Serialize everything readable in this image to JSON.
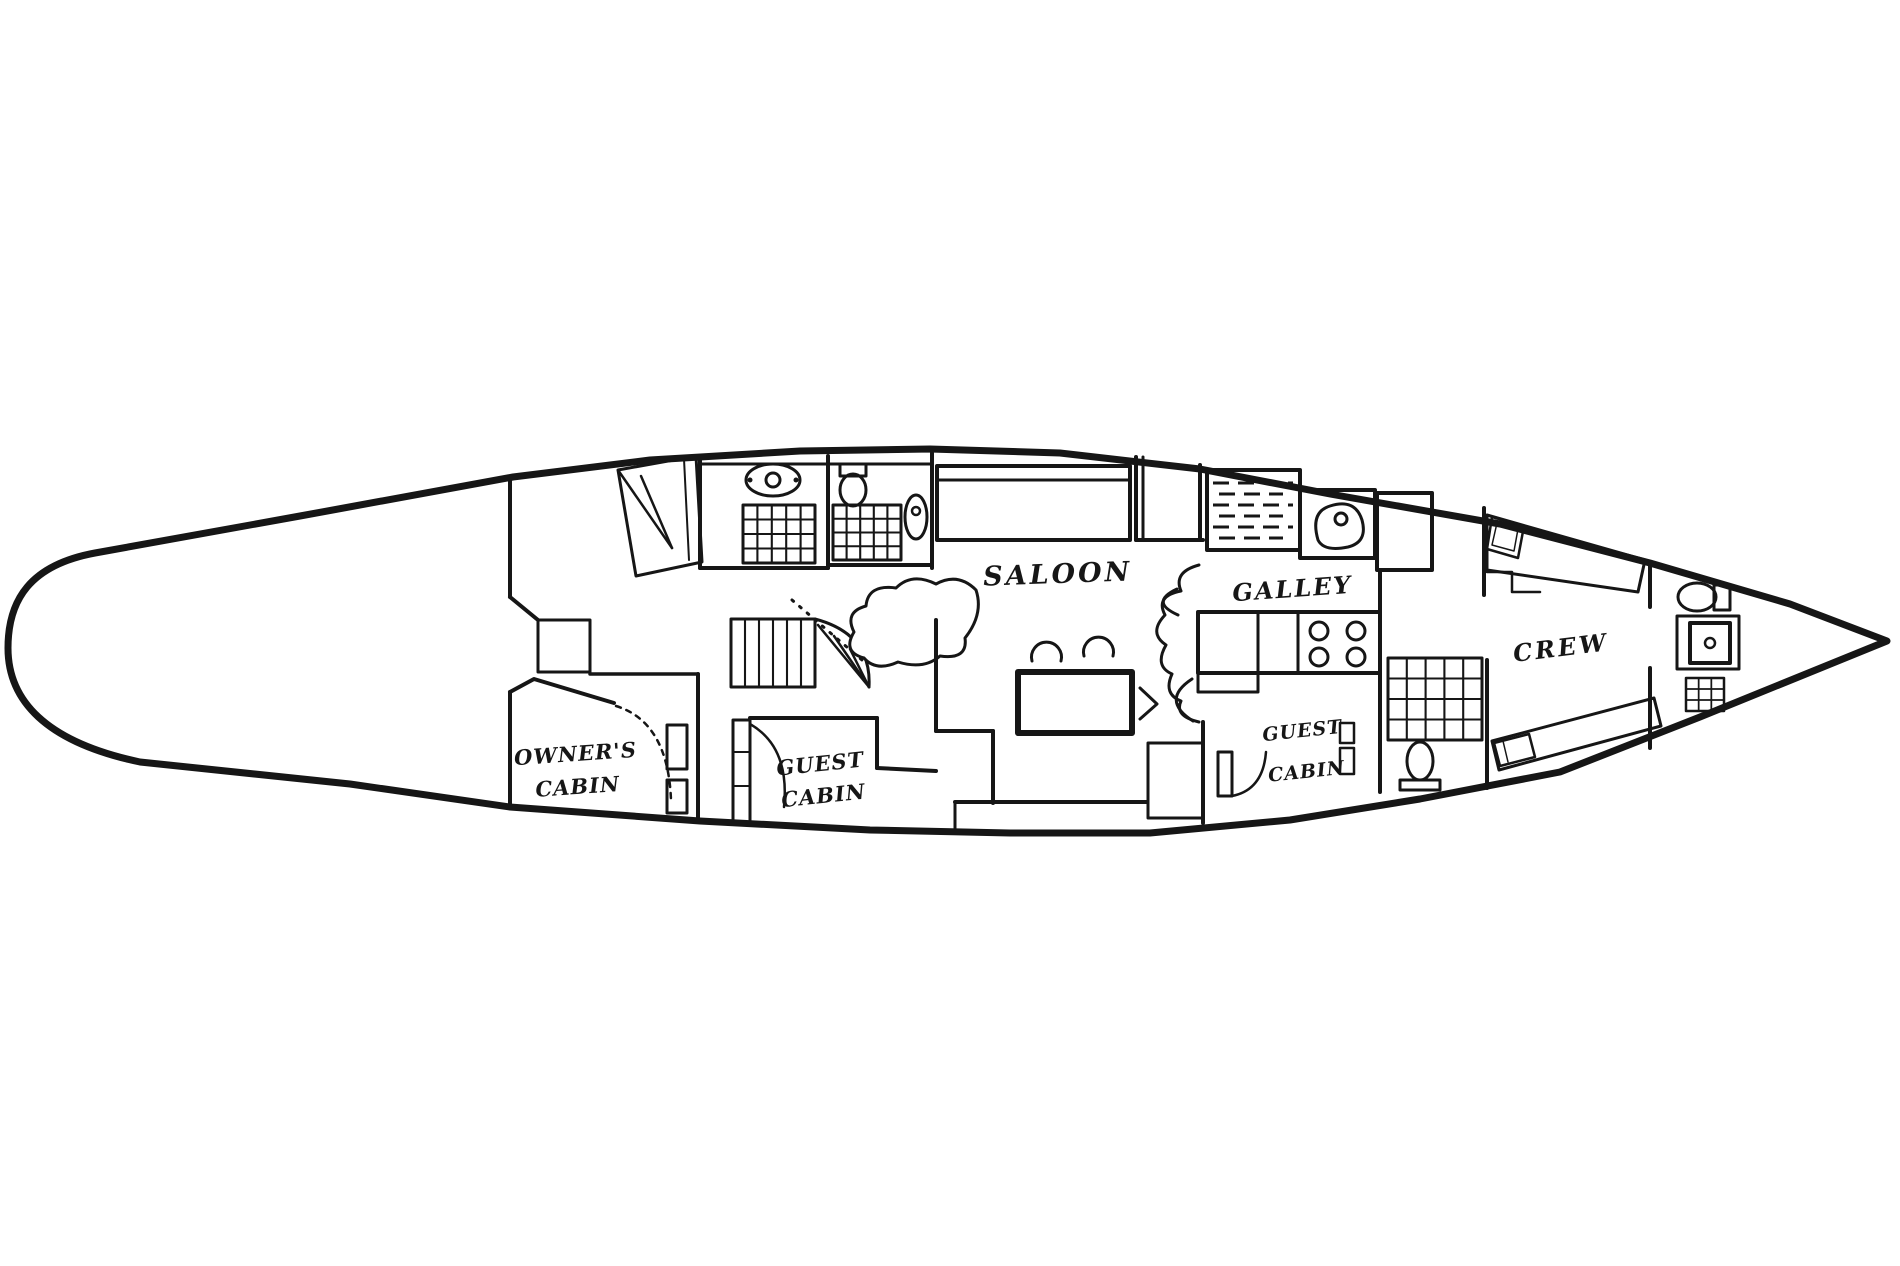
{
  "page": {
    "background": "#ffffff",
    "ink": "#161616"
  },
  "floorplan": {
    "canvas": {
      "width": 1900,
      "height": 1266
    },
    "rooms": [
      "OWNER'S CABIN",
      "GUEST CABIN",
      "SALOON",
      "GALLEY",
      "GUEST CABIN",
      "CREW"
    ],
    "labels": [
      {
        "name": "label-saloon",
        "lines": [
          "SALOON"
        ],
        "x": 1058,
        "y": 583,
        "size": 27,
        "rotate": -2,
        "ls": 3,
        "lh": 0
      },
      {
        "name": "label-galley",
        "lines": [
          "GALLEY"
        ],
        "x": 1293,
        "y": 597,
        "size": 24,
        "rotate": -4,
        "ls": 2,
        "lh": 0
      },
      {
        "name": "label-crew",
        "lines": [
          "CREW"
        ],
        "x": 1562,
        "y": 656,
        "size": 24,
        "rotate": -7,
        "ls": 3,
        "lh": 0
      },
      {
        "name": "label-owners-cabin",
        "lines": [
          "OWNER'S",
          "CABIN"
        ],
        "x": 576,
        "y": 761,
        "size": 21,
        "rotate": -4,
        "ls": 1,
        "lh": 33
      },
      {
        "name": "label-guest-cabin-port",
        "lines": [
          "GUEST",
          "CABIN"
        ],
        "x": 821,
        "y": 771,
        "size": 21,
        "rotate": -6,
        "ls": 1,
        "lh": 32
      },
      {
        "name": "label-guest-cabin-starboard",
        "lines": [
          "GUEST",
          "CABIN"
        ],
        "x": 1303,
        "y": 737,
        "size": 19,
        "rotate": -6,
        "ls": 1,
        "lh": 41
      }
    ],
    "shapes": [
      {
        "name": "hull-outline",
        "type": "path",
        "sw": 7,
        "d": "M95 553 L300 516 L513 477 L650 460 L800 451 L930 449 L1060 453 L1200 469 L1330 494 L1500 524 L1650 563 L1790 604 L1887 641 L1700 717 L1560 772 L1420 799 L1290 820 L1150 833 L1010 833 L870 830 L700 821 L510 807 L350 784 L140 762 C45 742 8 700 8 648 C8 600 30 565 95 553 Z"
      },
      {
        "name": "aft-bulkhead",
        "type": "line",
        "sw": 4,
        "x1": 510,
        "y1": 478,
        "x2": 510,
        "y2": 597
      },
      {
        "name": "aft-bulkhead-step",
        "type": "line",
        "sw": 4,
        "x1": 510,
        "y1": 597,
        "x2": 538,
        "y2": 620
      },
      {
        "name": "aft-locker",
        "type": "polyline",
        "sw": 3,
        "points": "538,672 538,620 590,620 590,672 538,672"
      },
      {
        "name": "owners-cabin-top-wall",
        "type": "line",
        "sw": 3.5,
        "x1": 590,
        "y1": 674,
        "x2": 698,
        "y2": 674
      },
      {
        "name": "owners-cabin-front-wall",
        "type": "polyline",
        "sw": 4,
        "points": "510,692 534,679 614,703"
      },
      {
        "name": "owners-cabin-left-wall",
        "type": "line",
        "sw": 4,
        "x1": 510,
        "y1": 692,
        "x2": 510,
        "y2": 806
      },
      {
        "name": "owners-guest-bulkhead",
        "type": "line",
        "sw": 4,
        "x1": 698,
        "y1": 674,
        "x2": 698,
        "y2": 822
      },
      {
        "name": "owners-door-swing",
        "type": "path",
        "sw": 2.5,
        "dash": "5 6",
        "d": "M616 706 Q668 722 671 800"
      },
      {
        "name": "owners-door-frame-1",
        "type": "rect",
        "sw": 3,
        "x": 667,
        "y": 725,
        "w": 20,
        "h": 44
      },
      {
        "name": "owners-door-frame-2",
        "type": "rect",
        "sw": 3,
        "x": 667,
        "y": 780,
        "w": 20,
        "h": 33
      },
      {
        "name": "owners-berth",
        "type": "polygon",
        "sw": 3,
        "points": "618,470 696,456 702,562 636,576"
      },
      {
        "name": "owners-berth-fold-1",
        "type": "line",
        "sw": 2.5,
        "x1": 618,
        "y1": 470,
        "x2": 672,
        "y2": 548
      },
      {
        "name": "owners-berth-fold-2",
        "type": "line",
        "sw": 2.5,
        "x1": 641,
        "y1": 476,
        "x2": 672,
        "y2": 548
      },
      {
        "name": "owners-berth-edge",
        "type": "line",
        "sw": 2,
        "x1": 684,
        "y1": 459,
        "x2": 689,
        "y2": 560
      },
      {
        "name": "head-bulkhead-aft",
        "type": "line",
        "sw": 4,
        "x1": 700,
        "y1": 456,
        "x2": 700,
        "y2": 568
      },
      {
        "name": "head-floor-wall-1",
        "type": "line",
        "sw": 4,
        "x1": 700,
        "y1": 568,
        "x2": 828,
        "y2": 568
      },
      {
        "name": "head-bulkhead-mid",
        "type": "line",
        "sw": 4,
        "x1": 828,
        "y1": 456,
        "x2": 828,
        "y2": 568
      },
      {
        "name": "head-floor-wall-2",
        "type": "line",
        "sw": 4,
        "x1": 830,
        "y1": 565,
        "x2": 932,
        "y2": 565
      },
      {
        "name": "head-bulkhead-fwd",
        "type": "line",
        "sw": 4,
        "x1": 932,
        "y1": 453,
        "x2": 932,
        "y2": 568
      },
      {
        "name": "head-ceiling-line",
        "type": "line",
        "sw": 3,
        "x1": 702,
        "y1": 464,
        "x2": 930,
        "y2": 464
      },
      {
        "name": "sink-icon",
        "type": "ellipse",
        "sw": 3,
        "cx": 773,
        "cy": 480,
        "rx": 27,
        "ry": 16
      },
      {
        "name": "sink-drain",
        "type": "circle",
        "sw": 3,
        "cx": 773,
        "cy": 480,
        "r": 7
      },
      {
        "name": "sink-tap-left",
        "type": "circle",
        "sw": 0,
        "fill": "#161616",
        "cx": 750,
        "cy": 480,
        "r": 2.5
      },
      {
        "name": "sink-tap-right",
        "type": "circle",
        "sw": 0,
        "fill": "#161616",
        "cx": 796,
        "cy": 480,
        "r": 2.5
      },
      {
        "name": "toilet-tank",
        "type": "rect",
        "sw": 3,
        "x": 840,
        "y": 464,
        "w": 26,
        "h": 12
      },
      {
        "name": "toilet-icon",
        "type": "ellipse",
        "sw": 3,
        "cx": 853,
        "cy": 490,
        "rx": 13,
        "ry": 16
      },
      {
        "name": "shower-grate-1",
        "type": "grid",
        "sw": 3,
        "x": 743,
        "y": 505,
        "w": 72,
        "h": 58,
        "cols": 5,
        "rows": 4
      },
      {
        "name": "shower-grate-2",
        "type": "grid",
        "sw": 3,
        "x": 833,
        "y": 505,
        "w": 68,
        "h": 55,
        "cols": 5,
        "rows": 4
      },
      {
        "name": "washbasin-icon",
        "type": "ellipse",
        "sw": 3,
        "cx": 916,
        "cy": 517,
        "rx": 11,
        "ry": 22
      },
      {
        "name": "washbasin-drain",
        "type": "circle",
        "sw": 2.5,
        "cx": 916,
        "cy": 511,
        "r": 4
      },
      {
        "name": "companionway-steps",
        "type": "grid",
        "sw": 3,
        "x": 731,
        "y": 619,
        "w": 84,
        "h": 68,
        "cols": 6,
        "rows": 1
      },
      {
        "name": "stair-fan-edge",
        "type": "path",
        "sw": 3,
        "d": "M815 619 Q872 634 869 687"
      },
      {
        "name": "stair-fan-tread-1",
        "type": "line",
        "sw": 2.5,
        "x1": 869,
        "y1": 687,
        "x2": 818,
        "y2": 625
      },
      {
        "name": "stair-fan-tread-2",
        "type": "line",
        "sw": 2.5,
        "x1": 869,
        "y1": 687,
        "x2": 834,
        "y2": 636
      },
      {
        "name": "stair-fan-tread-3",
        "type": "line",
        "sw": 2.5,
        "x1": 869,
        "y1": 687,
        "x2": 850,
        "y2": 649
      },
      {
        "name": "stair-handrail-dotted",
        "type": "line",
        "sw": 3,
        "dash": "2 8",
        "x1": 792,
        "y1": 600,
        "x2": 862,
        "y2": 660
      },
      {
        "name": "engine-box",
        "type": "path",
        "sw": 3,
        "fill": "#ffffff",
        "d": "M976 590 Q958 572 936 584 Q912 572 896 588 Q868 584 866 606 Q844 612 854 632 Q842 652 864 658 Q876 672 898 662 Q924 670 940 656 Q968 660 965 638 Q984 614 976 590 Z"
      },
      {
        "name": "guest-door-louvered",
        "type": "rect",
        "sw": 3,
        "x": 733,
        "y": 720,
        "w": 17,
        "h": 102
      },
      {
        "name": "guest-door-louver-1",
        "type": "line",
        "sw": 2,
        "x1": 733,
        "y1": 752,
        "x2": 750,
        "y2": 752
      },
      {
        "name": "guest-door-louver-2",
        "type": "line",
        "sw": 2,
        "x1": 733,
        "y1": 786,
        "x2": 750,
        "y2": 786
      },
      {
        "name": "guest-door-swing",
        "type": "path",
        "sw": 2.5,
        "d": "M750 724 Q790 747 784 807"
      },
      {
        "name": "guest-cabin-top-wall",
        "type": "line",
        "sw": 4,
        "x1": 750,
        "y1": 718,
        "x2": 877,
        "y2": 718
      },
      {
        "name": "guest-cabin-right-wall",
        "type": "line",
        "sw": 4,
        "x1": 877,
        "y1": 718,
        "x2": 877,
        "y2": 768
      },
      {
        "name": "guest-cabin-jog-wall",
        "type": "line",
        "sw": 4,
        "x1": 877,
        "y1": 768,
        "x2": 936,
        "y2": 771
      },
      {
        "name": "saloon-wall-left",
        "type": "line",
        "sw": 4,
        "x1": 936,
        "y1": 620,
        "x2": 936,
        "y2": 731
      },
      {
        "name": "saloon-wall-step",
        "type": "line",
        "sw": 4,
        "x1": 936,
        "y1": 731,
        "x2": 993,
        "y2": 731
      },
      {
        "name": "saloon-wall-down",
        "type": "line",
        "sw": 4,
        "x1": 993,
        "y1": 731,
        "x2": 993,
        "y2": 803
      },
      {
        "name": "saloon-bench",
        "type": "line",
        "sw": 4,
        "x1": 955,
        "y1": 802,
        "x2": 1147,
        "y2": 802
      },
      {
        "name": "saloon-bench-end",
        "type": "line",
        "sw": 3,
        "x1": 955,
        "y1": 802,
        "x2": 955,
        "y2": 830
      },
      {
        "name": "saloon-settee",
        "type": "rect",
        "sw": 4,
        "x": 937,
        "y": 466,
        "w": 193,
        "h": 74
      },
      {
        "name": "saloon-settee-back",
        "type": "line",
        "sw": 3,
        "x1": 937,
        "y1": 480,
        "x2": 1130,
        "y2": 480
      },
      {
        "name": "saloon-table",
        "type": "rect",
        "sw": 6,
        "x": 1018,
        "y": 672,
        "w": 114,
        "h": 61
      },
      {
        "name": "saloon-chair-1",
        "type": "path",
        "sw": 3,
        "d": "M1032 661 A15 15 0 1 1 1061 661"
      },
      {
        "name": "saloon-chair-2",
        "type": "path",
        "sw": 3,
        "d": "M1084 656 A15 15 0 1 1 1113 656"
      },
      {
        "name": "saloon-chair-3",
        "type": "path",
        "sw": 3,
        "d": "M1140 688 L1157 704 L1140 719"
      },
      {
        "name": "saloon-chair-4",
        "type": "path",
        "sw": 3,
        "d": "M1192 679 Q1160 700 1193 721"
      },
      {
        "name": "saloon-chair-5",
        "type": "path",
        "sw": 3,
        "d": "M1177 589 Q1149 602 1178 615"
      },
      {
        "name": "galley-bulkhead-1",
        "type": "line",
        "sw": 4,
        "x1": 1136,
        "y1": 457,
        "x2": 1136,
        "y2": 540
      },
      {
        "name": "galley-bulkhead-2",
        "type": "line",
        "sw": 3,
        "x1": 1143,
        "y1": 457,
        "x2": 1143,
        "y2": 540
      },
      {
        "name": "galley-bulkhead-3",
        "type": "line",
        "sw": 4,
        "x1": 1200,
        "y1": 465,
        "x2": 1200,
        "y2": 540
      },
      {
        "name": "companionway-sole",
        "type": "line",
        "sw": 4,
        "x1": 1136,
        "y1": 540,
        "x2": 1203,
        "y2": 540
      },
      {
        "name": "icebox",
        "type": "rect",
        "sw": 4,
        "x": 1207,
        "y": 470,
        "w": 93,
        "h": 80
      },
      {
        "name": "icebox-hatch-lines",
        "type": "hlines",
        "sw": 3,
        "x": 1213,
        "y": 483,
        "w": 80,
        "count": 6,
        "gap": 11,
        "dash": "16 9"
      },
      {
        "name": "galley-sink-unit",
        "type": "rect",
        "sw": 4,
        "x": 1300,
        "y": 490,
        "w": 75,
        "h": 68
      },
      {
        "name": "galley-sink-bowl",
        "type": "path",
        "sw": 3,
        "d": "M1318 540 Q1310 512 1330 506 Q1355 498 1362 520 Q1368 542 1348 547 Q1324 552 1318 540 Z"
      },
      {
        "name": "galley-sink-drain",
        "type": "circle",
        "sw": 3,
        "cx": 1341,
        "cy": 519,
        "r": 6
      },
      {
        "name": "fridge",
        "type": "rect",
        "sw": 4,
        "x": 1377,
        "y": 493,
        "w": 55,
        "h": 77
      },
      {
        "name": "galley-counter",
        "type": "rect",
        "sw": 4,
        "x": 1198,
        "y": 612,
        "w": 182,
        "h": 61
      },
      {
        "name": "galley-counter-div-1",
        "type": "line",
        "sw": 3,
        "x1": 1258,
        "y1": 612,
        "x2": 1258,
        "y2": 673
      },
      {
        "name": "galley-counter-div-2",
        "type": "line",
        "sw": 3,
        "x1": 1298,
        "y1": 612,
        "x2": 1298,
        "y2": 673
      },
      {
        "name": "galley-counter-ext",
        "type": "polyline",
        "sw": 3,
        "points": "1198,673 1198,692 1258,692 1258,673"
      },
      {
        "name": "stove-burner-1",
        "type": "circle",
        "sw": 3,
        "cx": 1319,
        "cy": 631,
        "r": 9
      },
      {
        "name": "stove-burner-2",
        "type": "circle",
        "sw": 3,
        "cx": 1356,
        "cy": 631,
        "r": 9
      },
      {
        "name": "stove-burner-3",
        "type": "circle",
        "sw": 3,
        "cx": 1319,
        "cy": 657,
        "r": 9
      },
      {
        "name": "stove-burner-4",
        "type": "circle",
        "sw": 3,
        "cx": 1356,
        "cy": 657,
        "r": 9
      },
      {
        "name": "galley-screen",
        "type": "path",
        "sw": 3,
        "d": "M1199 565 Q1173 572 1181 591 Q1155 596 1165 615 Q1148 633 1166 645 Q1154 666 1172 674 Q1163 694 1181 701 Q1174 716 1199 722"
      },
      {
        "name": "starboard-seat",
        "type": "rect",
        "sw": 3,
        "x": 1148,
        "y": 743,
        "w": 55,
        "h": 75
      },
      {
        "name": "starboard-cabin-wall",
        "type": "line",
        "sw": 4,
        "x1": 1203,
        "y1": 722,
        "x2": 1203,
        "y2": 823
      },
      {
        "name": "starboard-door",
        "type": "rect",
        "sw": 3,
        "x": 1218,
        "y": 752,
        "w": 14,
        "h": 44
      },
      {
        "name": "starboard-door-swing",
        "type": "path",
        "sw": 2.5,
        "d": "M1232 796 Q1263 790 1266 752"
      },
      {
        "name": "starboard-shelf-1",
        "type": "rect",
        "sw": 2.5,
        "x": 1340,
        "y": 723,
        "w": 14,
        "h": 20
      },
      {
        "name": "starboard-shelf-2",
        "type": "rect",
        "sw": 2.5,
        "x": 1340,
        "y": 748,
        "w": 14,
        "h": 26
      },
      {
        "name": "crew-bulkhead-aft",
        "type": "line",
        "sw": 4,
        "x1": 1380,
        "y1": 572,
        "x2": 1380,
        "y2": 792
      },
      {
        "name": "crew-bunk-grate",
        "type": "grid",
        "sw": 3,
        "x": 1388,
        "y": 658,
        "w": 94,
        "h": 82,
        "cols": 5,
        "rows": 4
      },
      {
        "name": "crew-toilet-icon",
        "type": "ellipse",
        "sw": 3,
        "cx": 1420,
        "cy": 761,
        "rx": 13,
        "ry": 19
      },
      {
        "name": "crew-toilet-base",
        "type": "rect",
        "sw": 3,
        "x": 1400,
        "y": 780,
        "w": 40,
        "h": 10
      },
      {
        "name": "crew-bulkhead-top",
        "type": "line",
        "sw": 4,
        "x1": 1484,
        "y1": 508,
        "x2": 1484,
        "y2": 595
      },
      {
        "name": "crew-bulkhead-fwd",
        "type": "line",
        "sw": 4,
        "x1": 1487,
        "y1": 660,
        "x2": 1487,
        "y2": 788
      },
      {
        "name": "crew-berth-upper",
        "type": "polygon",
        "sw": 3,
        "points": "1487,515 1645,560 1638,592 1487,570"
      },
      {
        "name": "crew-berth-upper-step",
        "type": "polyline",
        "sw": 2.5,
        "points": "1487,572 1512,572 1512,592 1540,592"
      },
      {
        "name": "crew-pillow-upper",
        "type": "polygon",
        "sw": 2.5,
        "points": "1492,517 1524,526 1518,558 1487,549"
      },
      {
        "name": "crew-pillow-upper-inner",
        "type": "polygon",
        "sw": 1.5,
        "points": "1497,523 1518,529 1514,551 1492,545"
      },
      {
        "name": "crew-berth-lower",
        "type": "polygon",
        "sw": 3,
        "points": "1492,741 1654,698 1661,726 1499,770"
      },
      {
        "name": "crew-pillow-lower",
        "type": "polygon",
        "sw": 2.5,
        "points": "1494,743 1529,734 1535,757 1500,766"
      },
      {
        "name": "crew-pillow-lower-line",
        "type": "line",
        "sw": 1.5,
        "x1": 1503,
        "y1": 741,
        "x2": 1508,
        "y2": 762
      },
      {
        "name": "forepeak-bulkhead-upper",
        "type": "line",
        "sw": 4,
        "x1": 1650,
        "y1": 565,
        "x2": 1650,
        "y2": 607
      },
      {
        "name": "forepeak-bulkhead-lower",
        "type": "line",
        "sw": 4,
        "x1": 1650,
        "y1": 668,
        "x2": 1650,
        "y2": 748
      },
      {
        "name": "forepeak-toilet-icon",
        "type": "ellipse",
        "sw": 3,
        "cx": 1697,
        "cy": 597,
        "rx": 19,
        "ry": 14
      },
      {
        "name": "forepeak-toilet-tank",
        "type": "rect",
        "sw": 3,
        "x": 1714,
        "y": 585,
        "w": 16,
        "h": 25
      },
      {
        "name": "forepeak-shower-outer",
        "type": "rect",
        "sw": 3,
        "x": 1677,
        "y": 616,
        "w": 62,
        "h": 53
      },
      {
        "name": "forepeak-shower-inner",
        "type": "rect",
        "sw": 4,
        "x": 1690,
        "y": 623,
        "w": 40,
        "h": 40
      },
      {
        "name": "forepeak-shower-drain",
        "type": "circle",
        "sw": 2.5,
        "cx": 1710,
        "cy": 643,
        "r": 5
      },
      {
        "name": "forepeak-grate",
        "type": "grid",
        "sw": 2.5,
        "x": 1686,
        "y": 678,
        "w": 38,
        "h": 33,
        "cols": 3,
        "rows": 3
      }
    ]
  }
}
